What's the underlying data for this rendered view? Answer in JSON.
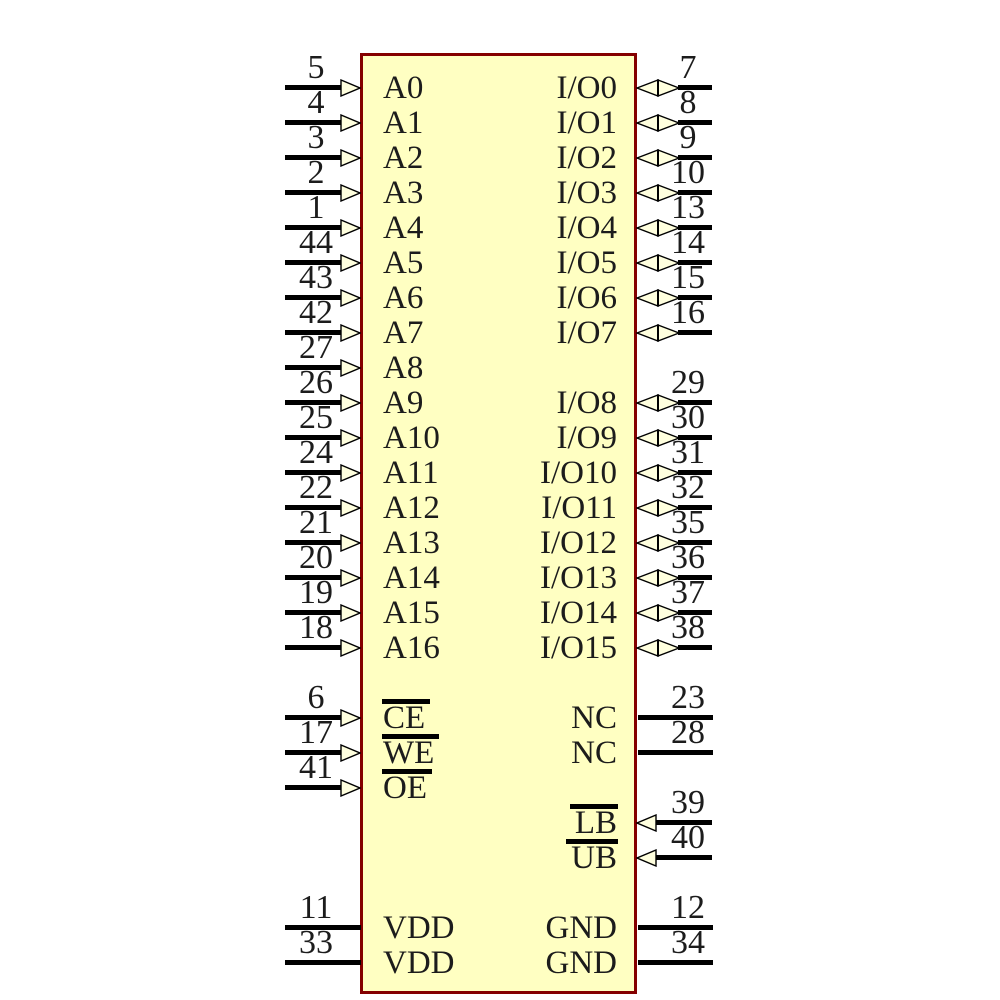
{
  "diagram": {
    "kind": "ic-schematic-symbol",
    "colors": {
      "body_fill": "#FFFFC2",
      "body_border": "#840000",
      "wire": "#000000",
      "arrow_fill": "#FFFFDE",
      "text": "#1c1c1c",
      "background": "#FFFFFF"
    },
    "left_pins": [
      {
        "number": "5",
        "label": "A0",
        "row": 0,
        "arrow": "input",
        "overline": false
      },
      {
        "number": "4",
        "label": "A1",
        "row": 1,
        "arrow": "input",
        "overline": false
      },
      {
        "number": "3",
        "label": "A2",
        "row": 2,
        "arrow": "input",
        "overline": false
      },
      {
        "number": "2",
        "label": "A3",
        "row": 3,
        "arrow": "input",
        "overline": false
      },
      {
        "number": "1",
        "label": "A4",
        "row": 4,
        "arrow": "input",
        "overline": false
      },
      {
        "number": "44",
        "label": "A5",
        "row": 5,
        "arrow": "input",
        "overline": false
      },
      {
        "number": "43",
        "label": "A6",
        "row": 6,
        "arrow": "input",
        "overline": false
      },
      {
        "number": "42",
        "label": "A7",
        "row": 7,
        "arrow": "input",
        "overline": false
      },
      {
        "number": "27",
        "label": "A8",
        "row": 8,
        "arrow": "input",
        "overline": false
      },
      {
        "number": "26",
        "label": "A9",
        "row": 9,
        "arrow": "input",
        "overline": false
      },
      {
        "number": "25",
        "label": "A10",
        "row": 10,
        "arrow": "input",
        "overline": false
      },
      {
        "number": "24",
        "label": "A11",
        "row": 11,
        "arrow": "input",
        "overline": false
      },
      {
        "number": "22",
        "label": "A12",
        "row": 12,
        "arrow": "input",
        "overline": false
      },
      {
        "number": "21",
        "label": "A13",
        "row": 13,
        "arrow": "input",
        "overline": false
      },
      {
        "number": "20",
        "label": "A14",
        "row": 14,
        "arrow": "input",
        "overline": false
      },
      {
        "number": "19",
        "label": "A15",
        "row": 15,
        "arrow": "input",
        "overline": false
      },
      {
        "number": "18",
        "label": "A16",
        "row": 16,
        "arrow": "input",
        "overline": false
      },
      {
        "number": "6",
        "label": "CE",
        "row": 18,
        "arrow": "input",
        "overline": true
      },
      {
        "number": "17",
        "label": "WE",
        "row": 19,
        "arrow": "input",
        "overline": true
      },
      {
        "number": "41",
        "label": "OE",
        "row": 20,
        "arrow": "input",
        "overline": true
      },
      {
        "number": "11",
        "label": "VDD",
        "row": 24,
        "arrow": "none",
        "overline": false
      },
      {
        "number": "33",
        "label": "VDD",
        "row": 25,
        "arrow": "none",
        "overline": false
      }
    ],
    "right_pins": [
      {
        "number": "7",
        "label": "I/O0",
        "row": 0,
        "arrow": "bidir",
        "overline": false
      },
      {
        "number": "8",
        "label": "I/O1",
        "row": 1,
        "arrow": "bidir",
        "overline": false
      },
      {
        "number": "9",
        "label": "I/O2",
        "row": 2,
        "arrow": "bidir",
        "overline": false
      },
      {
        "number": "10",
        "label": "I/O3",
        "row": 3,
        "arrow": "bidir",
        "overline": false
      },
      {
        "number": "13",
        "label": "I/O4",
        "row": 4,
        "arrow": "bidir",
        "overline": false
      },
      {
        "number": "14",
        "label": "I/O5",
        "row": 5,
        "arrow": "bidir",
        "overline": false
      },
      {
        "number": "15",
        "label": "I/O6",
        "row": 6,
        "arrow": "bidir",
        "overline": false
      },
      {
        "number": "16",
        "label": "I/O7",
        "row": 7,
        "arrow": "bidir",
        "overline": false
      },
      {
        "number": "29",
        "label": "I/O8",
        "row": 9,
        "arrow": "bidir",
        "overline": false
      },
      {
        "number": "30",
        "label": "I/O9",
        "row": 10,
        "arrow": "bidir",
        "overline": false
      },
      {
        "number": "31",
        "label": "I/O10",
        "row": 11,
        "arrow": "bidir",
        "overline": false
      },
      {
        "number": "32",
        "label": "I/O11",
        "row": 12,
        "arrow": "bidir",
        "overline": false
      },
      {
        "number": "35",
        "label": "I/O12",
        "row": 13,
        "arrow": "bidir",
        "overline": false
      },
      {
        "number": "36",
        "label": "I/O13",
        "row": 14,
        "arrow": "bidir",
        "overline": false
      },
      {
        "number": "37",
        "label": "I/O14",
        "row": 15,
        "arrow": "bidir",
        "overline": false
      },
      {
        "number": "38",
        "label": "I/O15",
        "row": 16,
        "arrow": "bidir",
        "overline": false
      },
      {
        "number": "23",
        "label": "NC",
        "row": 18,
        "arrow": "none",
        "overline": false
      },
      {
        "number": "28",
        "label": "NC",
        "row": 19,
        "arrow": "none",
        "overline": false
      },
      {
        "number": "39",
        "label": "LB",
        "row": 21,
        "arrow": "input",
        "overline": true
      },
      {
        "number": "40",
        "label": "UB",
        "row": 22,
        "arrow": "input",
        "overline": true
      },
      {
        "number": "12",
        "label": "GND",
        "row": 24,
        "arrow": "none",
        "overline": false
      },
      {
        "number": "34",
        "label": "GND",
        "row": 25,
        "arrow": "none",
        "overline": false
      }
    ]
  }
}
